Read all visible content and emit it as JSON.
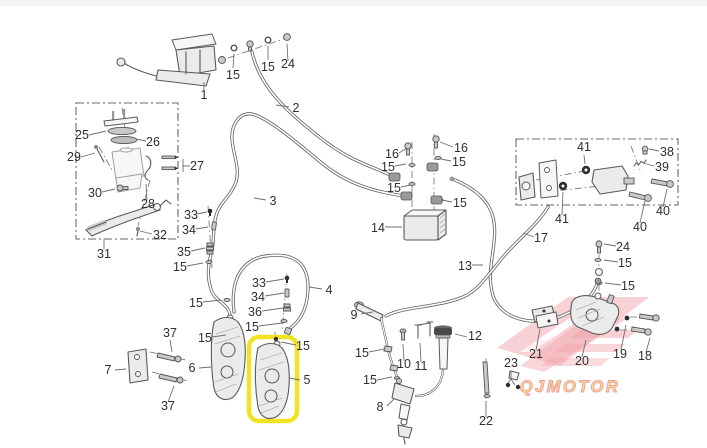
{
  "page": {
    "background": "#ffffff",
    "topbar_color": "#f3f3f3"
  },
  "diagram": {
    "type": "exploded-parts-diagram",
    "subject": "motorcycle brake system with ABS",
    "highlight": {
      "part_no": "5",
      "color": "#f2e224"
    },
    "watermark": {
      "text": "QJMOTOR",
      "text_color": "#f6df7a",
      "outline_color": "#ee8d98",
      "logo_color": "#efa3ab"
    },
    "callouts": [
      {
        "n": "15"
      },
      {
        "n": "15"
      },
      {
        "n": "24"
      },
      {
        "n": "1"
      },
      {
        "n": "2"
      },
      {
        "n": "25"
      },
      {
        "n": "26"
      },
      {
        "n": "29"
      },
      {
        "n": "27"
      },
      {
        "n": "30"
      },
      {
        "n": "28"
      },
      {
        "n": "32"
      },
      {
        "n": "31"
      },
      {
        "n": "33"
      },
      {
        "n": "34"
      },
      {
        "n": "35"
      },
      {
        "n": "15"
      },
      {
        "n": "3"
      },
      {
        "n": "15"
      },
      {
        "n": "15"
      },
      {
        "n": "33"
      },
      {
        "n": "34"
      },
      {
        "n": "36"
      },
      {
        "n": "15"
      },
      {
        "n": "4"
      },
      {
        "n": "15"
      },
      {
        "n": "16"
      },
      {
        "n": "16"
      },
      {
        "n": "15"
      },
      {
        "n": "15"
      },
      {
        "n": "15"
      },
      {
        "n": "15"
      },
      {
        "n": "14"
      },
      {
        "n": "41"
      },
      {
        "n": "38"
      },
      {
        "n": "39"
      },
      {
        "n": "40"
      },
      {
        "n": "41"
      },
      {
        "n": "40"
      },
      {
        "n": "17"
      },
      {
        "n": "13"
      },
      {
        "n": "24"
      },
      {
        "n": "15"
      },
      {
        "n": "15"
      },
      {
        "n": "21"
      },
      {
        "n": "20"
      },
      {
        "n": "19"
      },
      {
        "n": "18"
      },
      {
        "n": "23"
      },
      {
        "n": "9"
      },
      {
        "n": "15"
      },
      {
        "n": "10"
      },
      {
        "n": "11"
      },
      {
        "n": "12"
      },
      {
        "n": "15"
      },
      {
        "n": "8"
      },
      {
        "n": "22"
      },
      {
        "n": "37"
      },
      {
        "n": "7"
      },
      {
        "n": "6"
      },
      {
        "n": "5"
      },
      {
        "n": "37"
      }
    ]
  }
}
